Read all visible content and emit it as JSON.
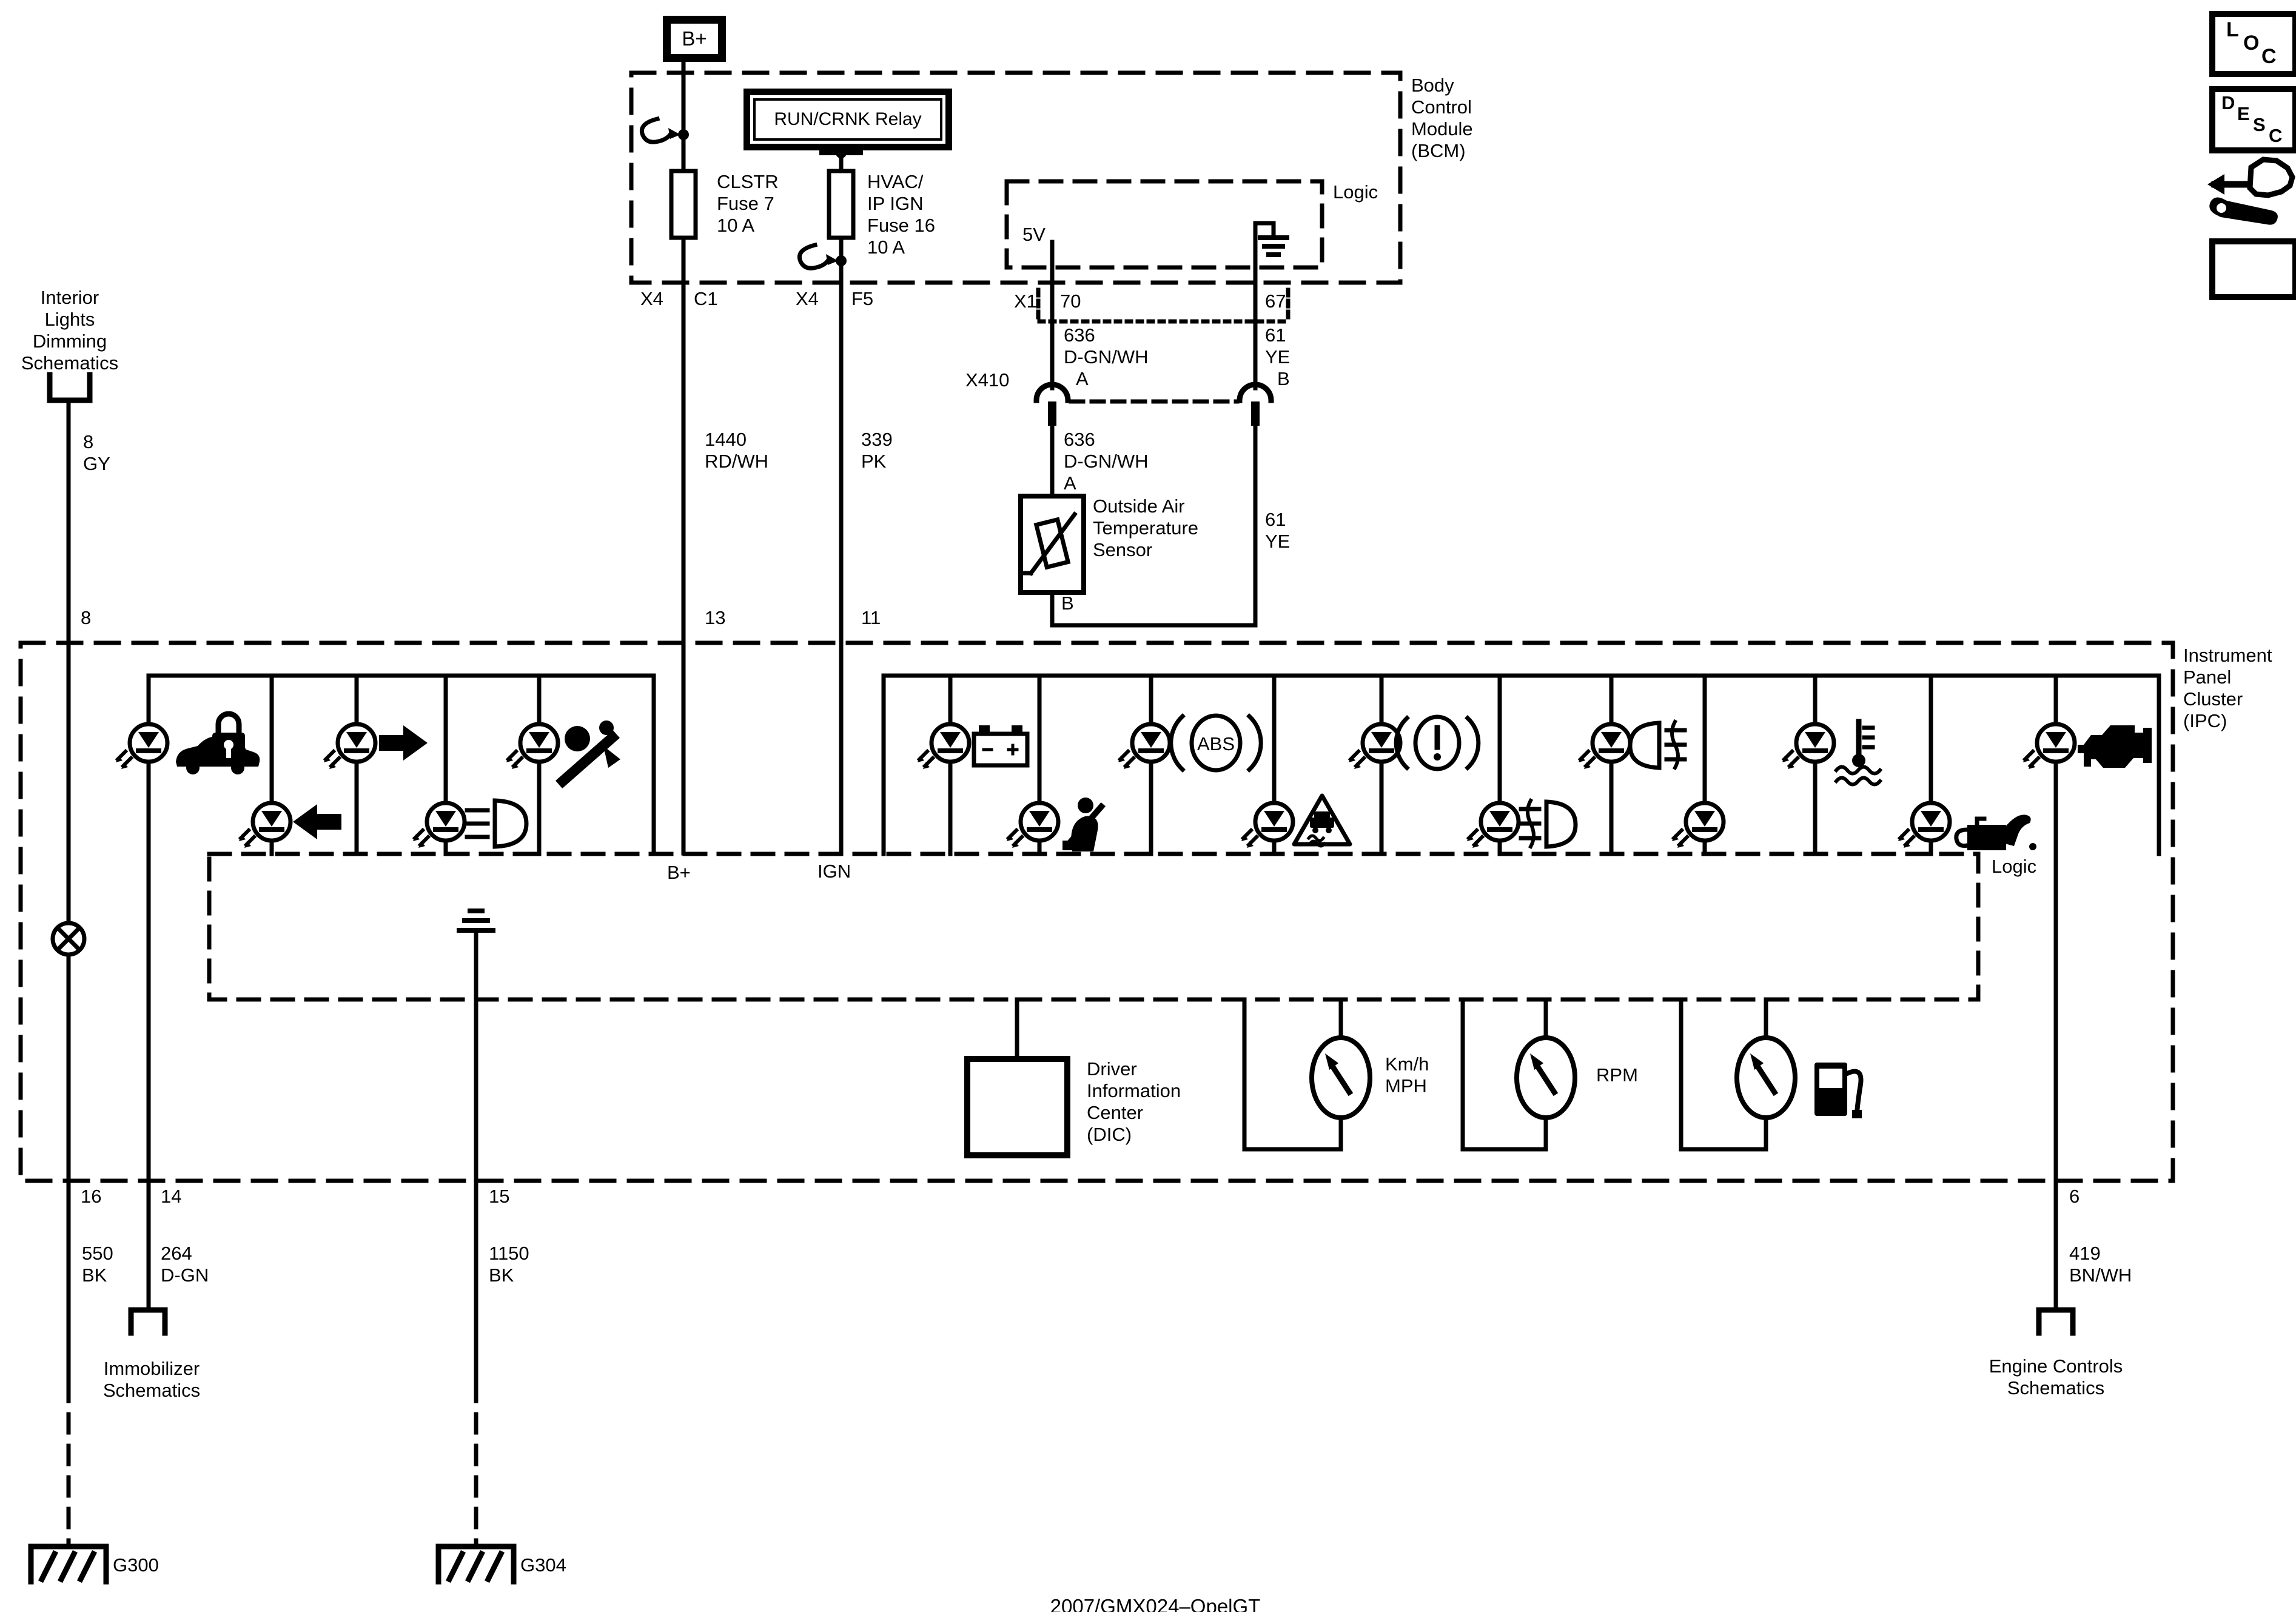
{
  "power": {
    "b_plus": "B+",
    "relay": "RUN/CRNK Relay",
    "fuse_clstr": {
      "l1": "CLSTR",
      "l2": "Fuse 7",
      "l3": "10 A"
    },
    "fuse_hvac": {
      "l1": "HVAC/",
      "l2": "IP IGN",
      "l3": "Fuse 16",
      "l4": "10 A"
    }
  },
  "bcm": {
    "name": {
      "l1": "Body",
      "l2": "Control",
      "l3": "Module",
      "l4": "(BCM)"
    },
    "logic_label": "Logic",
    "five_v": "5V",
    "pins": {
      "x4": "X4",
      "c1": "C1",
      "f5": "F5",
      "x1": "X1",
      "p70": "70",
      "p67": "67"
    }
  },
  "circuits": {
    "c1440": {
      "num": "1440",
      "color": "RD/WH"
    },
    "c339": {
      "num": "339",
      "color": "PK"
    },
    "c636": {
      "num": "636",
      "color": "D-GN/WH",
      "term": "A"
    },
    "c61": {
      "num": "61",
      "color": "YE",
      "term": "B"
    },
    "c8": {
      "num": "8",
      "color": "GY"
    },
    "c550": {
      "num": "550",
      "color": "BK"
    },
    "c264": {
      "num": "264",
      "color": "D-GN"
    },
    "c1150": {
      "num": "1150",
      "color": "BK"
    },
    "c419": {
      "num": "419",
      "color": "BN/WH"
    }
  },
  "x410": {
    "label": "X410"
  },
  "sensor": {
    "l1": "Outside Air",
    "l2": "Temperature",
    "l3": "Sensor",
    "pin_a": "A",
    "pin_b": "B"
  },
  "interior": {
    "l1": "Interior",
    "l2": "Lights",
    "l3": "Dimming",
    "l4": "Schematics"
  },
  "ipc": {
    "name": {
      "l1": "Instrument",
      "l2": "Panel",
      "l3": "Cluster",
      "l4": "(IPC)"
    },
    "logic_label": "Logic",
    "b_plus": "B+",
    "ign": "IGN",
    "abs_text": "ABS",
    "pins": {
      "p8": "8",
      "p13": "13",
      "p11": "11",
      "p16": "16",
      "p14": "14",
      "p15": "15",
      "p6": "6"
    },
    "lamp_icons": [
      "security-indicator",
      "left-turn",
      "right-turn",
      "low-beam",
      "airbag",
      "battery",
      "seatbelt",
      "abs",
      "traction-control",
      "brake-warning",
      "rear-fog",
      "front-fog",
      "indicator-plain",
      "coolant-temperature",
      "oil-pressure",
      "check-engine"
    ],
    "gauges": {
      "speed_l1": "Km/h",
      "speed_l2": "MPH",
      "rpm": "RPM",
      "fuel_icon": "fuel-pump"
    },
    "dic": {
      "l1": "Driver",
      "l2": "Information",
      "l3": "Center",
      "l4": "(DIC)"
    }
  },
  "offpage": {
    "immobilizer": {
      "l1": "Immobilizer",
      "l2": "Schematics"
    },
    "engine": {
      "l1": "Engine Controls",
      "l2": "Schematics"
    }
  },
  "grounds": {
    "g300": "G300",
    "g304": "G304"
  },
  "margin": {
    "loc": [
      "L",
      "O",
      "C"
    ],
    "desc": [
      "D",
      "E",
      "S",
      "C"
    ]
  },
  "footer": "2007/GMX024–OpelGT"
}
